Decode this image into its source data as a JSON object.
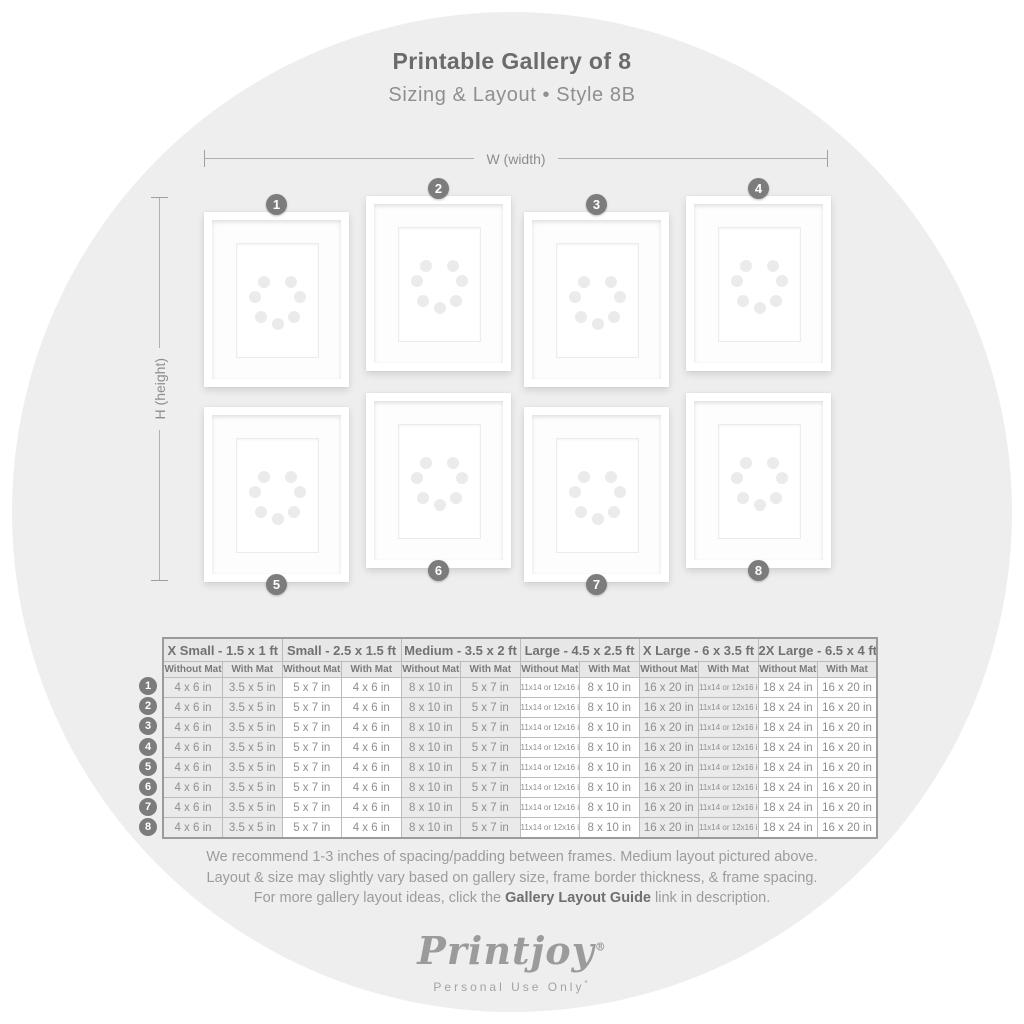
{
  "title": "Printable Gallery of 8",
  "subtitle": "Sizing & Layout • Style 8B",
  "dimensions": {
    "width_label": "W (width)",
    "height_label": "H (height)"
  },
  "frames": {
    "badges": [
      "1",
      "2",
      "3",
      "4",
      "5",
      "6",
      "7",
      "8"
    ]
  },
  "table": {
    "groups": [
      {
        "label": "X Small - 1.5 x 1 ft"
      },
      {
        "label": "Small - 2.5 x 1.5 ft"
      },
      {
        "label": "Medium - 3.5 x 2 ft"
      },
      {
        "label": "Large - 4.5 x 2.5 ft"
      },
      {
        "label": "X Large - 6 x 3.5 ft"
      },
      {
        "label": "2X Large - 6.5 x 4 ft"
      }
    ],
    "sub_headers": [
      "Without Mat",
      "With Mat"
    ],
    "rows": [
      {
        "number": "1",
        "cells": [
          "4 x 6 in",
          "3.5 x 5 in",
          "5 x 7 in",
          "4 x 6 in",
          "8 x 10 in",
          "5 x 7 in",
          "11x14 or 12x16 in",
          "8 x 10 in",
          "16 x 20 in",
          "11x14 or 12x16 in",
          "18 x 24 in",
          "16 x 20 in"
        ]
      },
      {
        "number": "2",
        "cells": [
          "4 x 6 in",
          "3.5 x 5 in",
          "5 x 7 in",
          "4 x 6 in",
          "8 x 10 in",
          "5 x 7 in",
          "11x14 or 12x16 in",
          "8 x 10 in",
          "16 x 20 in",
          "11x14 or 12x16 in",
          "18 x 24 in",
          "16 x 20 in"
        ]
      },
      {
        "number": "3",
        "cells": [
          "4 x 6 in",
          "3.5 x 5 in",
          "5 x 7 in",
          "4 x 6 in",
          "8 x 10 in",
          "5 x 7 in",
          "11x14 or 12x16 in",
          "8 x 10 in",
          "16 x 20 in",
          "11x14 or 12x16 in",
          "18 x 24 in",
          "16 x 20 in"
        ]
      },
      {
        "number": "4",
        "cells": [
          "4 x 6 in",
          "3.5 x 5 in",
          "5 x 7 in",
          "4 x 6 in",
          "8 x 10 in",
          "5 x 7 in",
          "11x14 or 12x16 in",
          "8 x 10 in",
          "16 x 20 in",
          "11x14 or 12x16 in",
          "18 x 24 in",
          "16 x 20 in"
        ]
      },
      {
        "number": "5",
        "cells": [
          "4 x 6 in",
          "3.5 x 5 in",
          "5 x 7 in",
          "4 x 6 in",
          "8 x 10 in",
          "5 x 7 in",
          "11x14 or 12x16 in",
          "8 x 10 in",
          "16 x 20 in",
          "11x14 or 12x16 in",
          "18 x 24 in",
          "16 x 20 in"
        ]
      },
      {
        "number": "6",
        "cells": [
          "4 x 6 in",
          "3.5 x 5 in",
          "5 x 7 in",
          "4 x 6 in",
          "8 x 10 in",
          "5 x 7 in",
          "11x14 or 12x16 in",
          "8 x 10 in",
          "16 x 20 in",
          "11x14 or 12x16 in",
          "18 x 24 in",
          "16 x 20 in"
        ]
      },
      {
        "number": "7",
        "cells": [
          "4 x 6 in",
          "3.5 x 5 in",
          "5 x 7 in",
          "4 x 6 in",
          "8 x 10 in",
          "5 x 7 in",
          "11x14 or 12x16 in",
          "8 x 10 in",
          "16 x 20 in",
          "11x14 or 12x16 in",
          "18 x 24 in",
          "16 x 20 in"
        ]
      },
      {
        "number": "8",
        "cells": [
          "4 x 6 in",
          "3.5 x 5 in",
          "5 x 7 in",
          "4 x 6 in",
          "8 x 10 in",
          "5 x 7 in",
          "11x14 or 12x16 in",
          "8 x 10 in",
          "16 x 20 in",
          "11x14 or 12x16 in",
          "18 x 24 in",
          "16 x 20 in"
        ]
      }
    ]
  },
  "footer": {
    "line1": "We recommend 1-3 inches of spacing/padding between frames. Medium layout pictured above.",
    "line2": "Layout & size may slightly vary based on gallery size, frame border thickness, & frame spacing.",
    "line3_prefix": "For more gallery layout ideas, click the ",
    "line3_link": "Gallery Layout Guide",
    "line3_suffix": " link in description."
  },
  "logo": {
    "name": "Printjoy",
    "registered": "®",
    "tagline": "Personal Use Only",
    "tagline_mark": "*"
  },
  "colors": {
    "circle_bg": "#eeeeef",
    "badge": "#7c7c7c",
    "table_header_bg": "#e7e7e8",
    "table_shaded_col": "#eaeaeb",
    "title_text": "#6b6b6b",
    "body_text": "#8f8f8f"
  }
}
